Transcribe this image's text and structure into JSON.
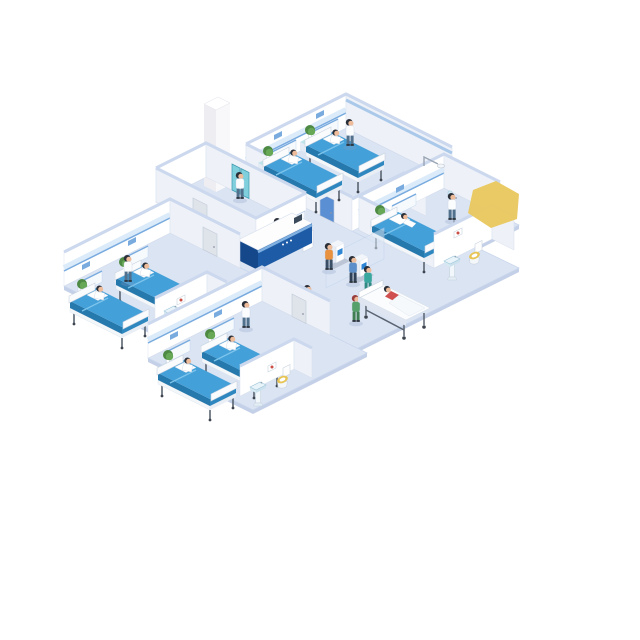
{
  "title": "Isometric hospital ward floor illustration",
  "background": "#ffffff",
  "palette": {
    "bg": "#ffffff",
    "floor": "#dbe4f3",
    "floor-edge": "#c9d6ec",
    "slab": "#c3d0e7",
    "wall": "#ffffff",
    "wall-shade": "#eef2f8",
    "wall-cap": "#ccd8ee",
    "stripe": "#79abdf",
    "stripe-band": "#dcebf9",
    "bed-top": "#44a0d9",
    "bed-side": "#2679ad",
    "bed-foot": "#2f87bf",
    "desk-front": "#1d5ba6",
    "desk-side": "#15488b",
    "desk-band": "#7fb0e0",
    "desk-top": "#fdfdfe",
    "screen-blue": "#2f86d4",
    "panel": "#f6fafd",
    "plant-green": "#4e8a43",
    "plant-green-light": "#67a857",
    "cabinet-top": "#bfe3ea",
    "elevator-teal": "#7fd0dc",
    "elevator-frame": "#3f9ab0",
    "highlight-yellow": "#e9c85f",
    "skin": "#eebc9a",
    "hair": "#2b2f38",
    "toilet-seat": "#e7c453",
    "art-red": "#c94f44",
    "shadow": "rgba(130,150,190,0.25)"
  },
  "scene": {
    "rooms": [
      {
        "name": "top-right-ward",
        "beds": 2,
        "patients": 2,
        "nurses": 1,
        "plants": 2,
        "bathroom": {
          "sink": true,
          "toilet": false,
          "wall_art": 1
        }
      },
      {
        "name": "right-ward",
        "beds": 1,
        "patients": 1,
        "doctors": 1,
        "plants": 1,
        "equipment": [
          "overhead-light",
          "iv-stand"
        ],
        "bathroom": {
          "sink": true,
          "toilet": true,
          "wall_art": 1
        }
      },
      {
        "name": "left-ward",
        "beds": 2,
        "patients": 2,
        "nurses": 1,
        "plants": 2,
        "bathroom": {
          "sink": true,
          "toilet": false,
          "wall_art": 1
        }
      },
      {
        "name": "bottom-ward",
        "beds": 2,
        "patients": 2,
        "nurses": 1,
        "plants": 2,
        "bathroom": {
          "sink": true,
          "toilet": true,
          "wall_art": 1
        }
      },
      {
        "name": "exam-room",
        "wall_monitors": 3,
        "blue_screens": 1,
        "elevator": true,
        "elevator_column": true,
        "staff": 1,
        "doors": 1
      }
    ],
    "lobby": {
      "reception_desk": 1,
      "receptionist": 1,
      "desk_screen": 1,
      "self_service_kiosks": 2,
      "kiosk_users": 2,
      "glass_partition": 1,
      "walking_visitors": 2,
      "walking_nurse_green": 1,
      "stretcher": {
        "patients": 1,
        "nurse_teal": 1
      }
    },
    "doors": {
      "gray": 3,
      "blue": 1
    },
    "highlight": {
      "shape": "yellow-polygon",
      "location": "upper-right-of-right-ward"
    },
    "people_total": 18
  }
}
